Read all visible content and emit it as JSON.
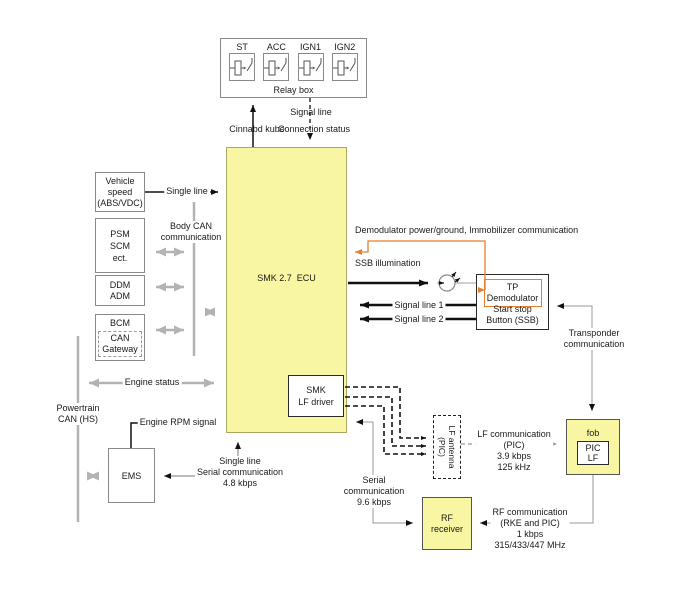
{
  "colors": {
    "ecu_fill": "#f8f6a2",
    "orange_accent": "#e87d2a",
    "gray_line": "#b3b3b3"
  },
  "relay_box": {
    "label": "Relay box",
    "relays": [
      "ST",
      "ACC",
      "IGN1",
      "IGN2"
    ]
  },
  "top": {
    "command_line": "Cinnabd kube",
    "signal_line": "Signal line",
    "connection_status": "Connection status"
  },
  "ecu": {
    "label": "SMK 2.7  ECU"
  },
  "boxes": {
    "vehicle_speed": [
      "Vehicle",
      "speed",
      "(ABS/VDC)"
    ],
    "psm": [
      "PSM",
      "SCM",
      "ect."
    ],
    "ddm": [
      "DDM",
      "ADM"
    ],
    "bcm": "BCM",
    "can_gateway": [
      "CAN",
      "Gateway"
    ],
    "ems": "EMS",
    "smk_lf_driver": [
      "SMK",
      "LF driver"
    ],
    "lf_antenna": [
      "LF antenna",
      "(PIC)"
    ],
    "tp_demodulator": [
      "TP",
      "Demodulator"
    ],
    "ssb": [
      "Start stop",
      "Button (SSB)"
    ],
    "fob": "fob",
    "pic_lf": [
      "PIC",
      "LF"
    ],
    "rf_receiver": [
      "RF",
      "receiver"
    ]
  },
  "labels": {
    "single_line": "Single line",
    "body_can": [
      "Body CAN",
      "communication"
    ],
    "engine_status": "Engine status",
    "powertrain": [
      "Powertrain",
      "CAN (HS)"
    ],
    "engine_rpm": "Engine RPM signal",
    "serial_48": [
      "Single line",
      "Serial communication",
      "4.8 kbps"
    ],
    "demod_power": "Demodulator power/ground, Immobilizer communication",
    "ssb_illumination": "SSB illumination",
    "signal_line_1": "Signal line 1",
    "signal_line_2": "Signal line 2",
    "transponder": [
      "Transponder",
      "communication"
    ],
    "lf_comm": [
      "LF communication",
      "(PIC)",
      "3.9 kbps",
      "125 kHz"
    ],
    "rf_comm": [
      "RF communication",
      "(RKE and PIC)",
      "1 kbps",
      "315/433/447 MHz"
    ],
    "serial_96": [
      "Serial",
      "communication",
      "9.6 kbps"
    ]
  }
}
